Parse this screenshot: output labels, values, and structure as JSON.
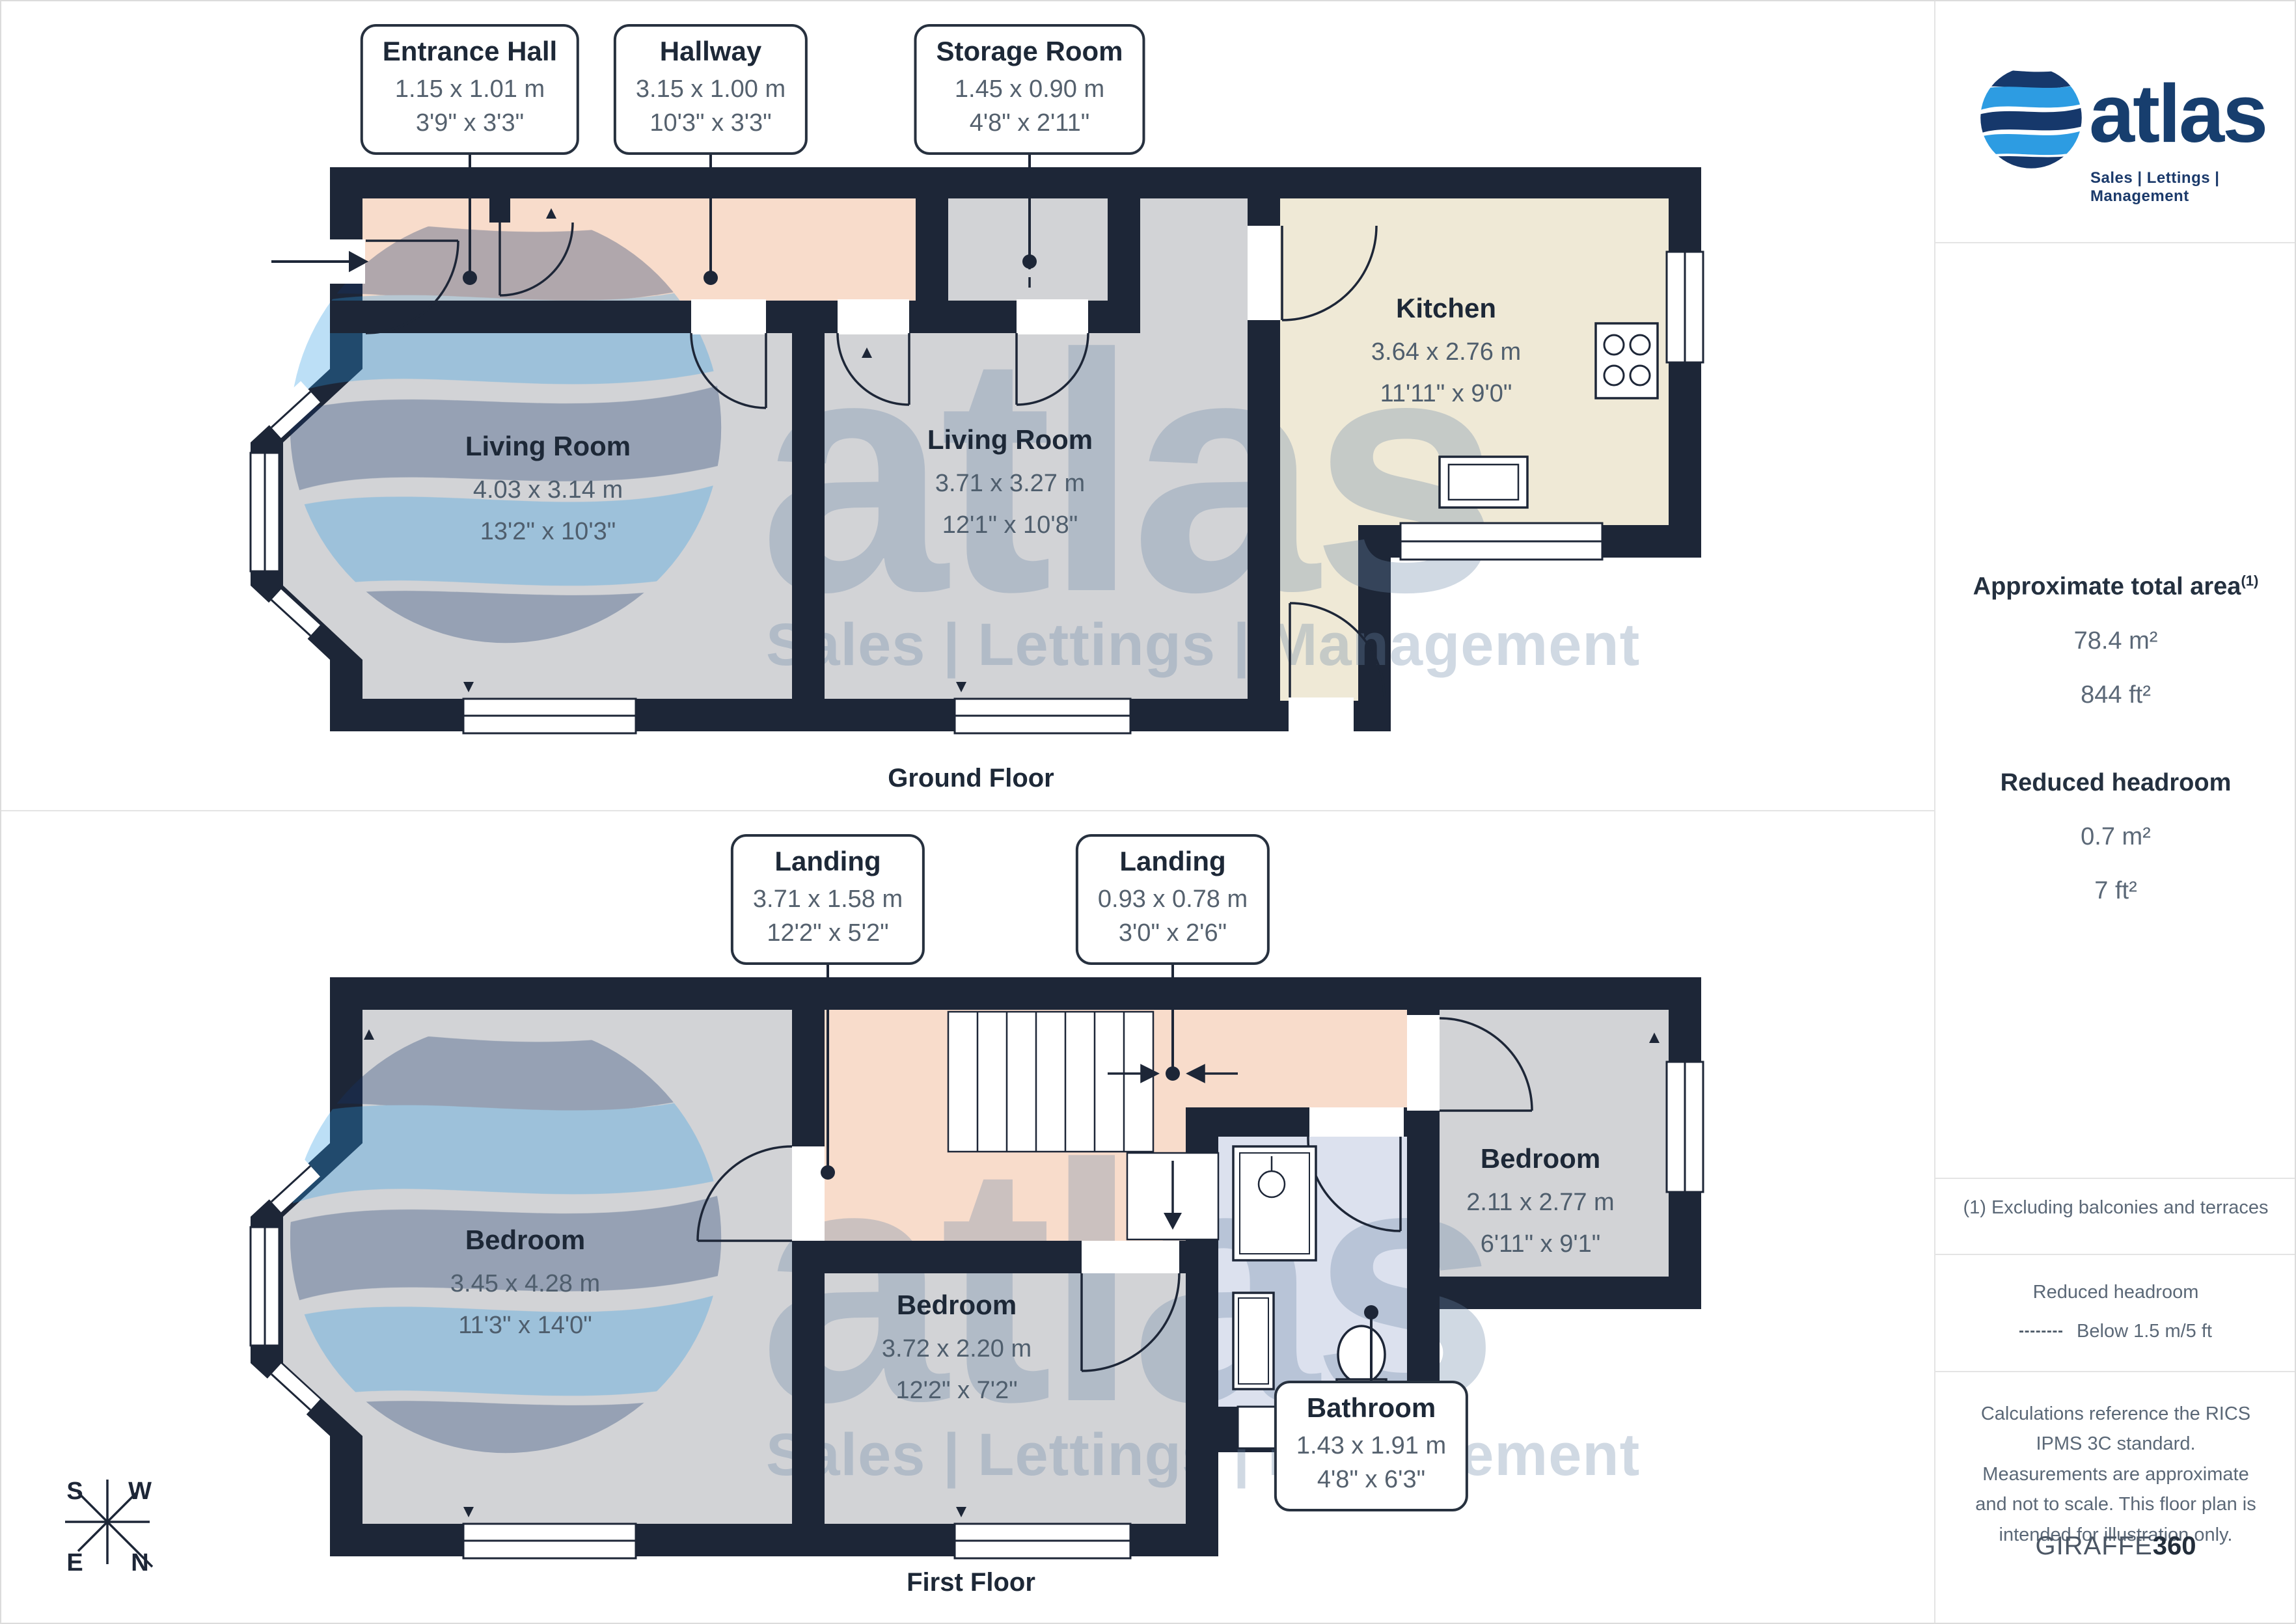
{
  "ground": {
    "caption": "Ground Floor",
    "callouts": [
      {
        "name": "Entrance Hall",
        "m": "1.15 x 1.01 m",
        "ft": "3'9\" x 3'3\""
      },
      {
        "name": "Hallway",
        "m": "3.15 x 1.00 m",
        "ft": "10'3\" x 3'3\""
      },
      {
        "name": "Storage Room",
        "m": "1.45 x 0.90 m",
        "ft": "4'8\" x 2'11\""
      }
    ],
    "rooms": [
      {
        "name": "Living Room",
        "m": "4.03 x 3.14 m",
        "ft": "13'2\" x 10'3\""
      },
      {
        "name": "Living Room",
        "m": "3.71 x 3.27 m",
        "ft": "12'1\" x 10'8\""
      },
      {
        "name": "Kitchen",
        "m": "3.64 x 2.76 m",
        "ft": "11'11\" x 9'0\""
      }
    ]
  },
  "first": {
    "caption": "First Floor",
    "callouts": [
      {
        "name": "Landing",
        "m": "3.71 x 1.58 m",
        "ft": "12'2\" x 5'2\""
      },
      {
        "name": "Landing",
        "m": "0.93 x 0.78 m",
        "ft": "3'0\" x 2'6\""
      },
      {
        "name": "Bathroom",
        "m": "1.43 x 1.91 m",
        "ft": "4'8\" x 6'3\""
      }
    ],
    "rooms": [
      {
        "name": "Bedroom",
        "m": "3.45 x 4.28 m",
        "ft": "11'3\" x 14'0\""
      },
      {
        "name": "Bedroom",
        "m": "3.72 x 2.20 m",
        "ft": "12'2\" x 7'2\""
      },
      {
        "name": "Bedroom",
        "m": "2.11 x 2.77 m",
        "ft": "6'11\" x 9'1\""
      }
    ]
  },
  "panel": {
    "brand": "atlas",
    "tagline": "Sales | Lettings | Management",
    "area_title": "Approximate total area",
    "area_sup": "(1)",
    "area_m2": "78.4 m²",
    "area_ft2": "844 ft²",
    "rh_title": "Reduced headroom",
    "rh_m2": "0.7 m²",
    "rh_ft2": "7 ft²",
    "note": "(1) Excluding balconies and terraces",
    "legend_title": "Reduced headroom",
    "legend_item": "Below 1.5 m/5 ft",
    "disclaimer": "Calculations reference the RICS IPMS 3C standard. Measurements are approximate and not to scale. This floor plan is intended for illustration only.",
    "credit_name": "GIRAFFE",
    "credit_num": "360"
  },
  "compass": {
    "s": "S",
    "w": "W",
    "e": "E",
    "n": "N"
  },
  "colors": {
    "wall": "#1d2637",
    "room": "#d2d3d6",
    "hall": "#f8dccb",
    "kitchen": "#efe9d6",
    "bath": "#dce1ee",
    "accent_light": "#2d9ce2",
    "accent_dark": "#16386b"
  }
}
